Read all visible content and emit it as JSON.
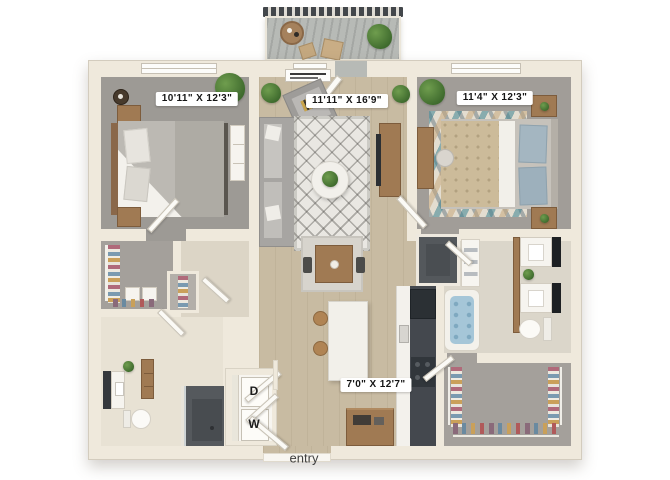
{
  "floor_plan": {
    "dimension_labels": {
      "bedroom_left": "10'11\" X 12'3\"",
      "living_room": "11'11\" X 16'9\"",
      "bedroom_right": "11'4\" X 12'3\"",
      "kitchen": "7'0\" X 12'7\""
    },
    "appliance_labels": {
      "dryer": "D",
      "washer": "W"
    },
    "entry_label": "entry",
    "colors": {
      "background": "#ffffff",
      "wall": "#efe9dc",
      "wood_floor": "#c8bba2",
      "bedroom_carpet": "#9d9a95",
      "bathroom_floor": "#e8e2d4",
      "kitchen_counter_dark": "#44484e",
      "shower_dark": "#55595d",
      "accent_wood": "#a07a53",
      "plant_green": "#4e7a3a",
      "tub_water": "#a5c6d8"
    }
  }
}
